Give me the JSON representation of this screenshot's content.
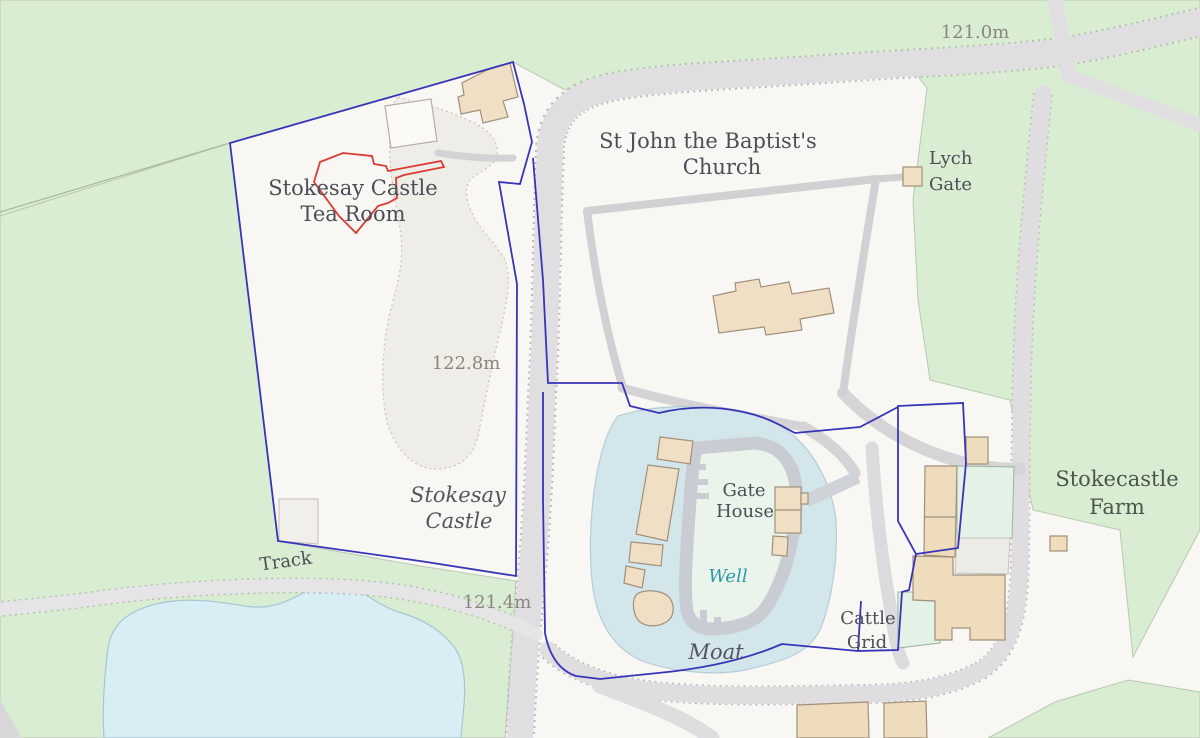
{
  "map": {
    "title": "Stokesay Castle area map",
    "labels": {
      "elevation_top": "121.0m",
      "elevation_mid": "122.8m",
      "elevation_bottom": "121.4m",
      "church": {
        "line1": "St John the Baptist's",
        "line2": "Church"
      },
      "lych_gate": {
        "line1": "Lych",
        "line2": "Gate"
      },
      "tea_room": {
        "line1": "Stokesay Castle",
        "line2": "Tea Room"
      },
      "castle": {
        "line1": "Stokesay",
        "line2": "Castle"
      },
      "gate_house": {
        "line1": "Gate",
        "line2": "House"
      },
      "well": "Well",
      "moat": "Moat",
      "cattle_grid": {
        "line1": "Cattle",
        "line2": "Grid"
      },
      "farm": {
        "line1": "Stokecastle",
        "line2": "Farm"
      },
      "track": "Track"
    },
    "colors": {
      "field_green": "#d9edd2",
      "parcel_white": "#f8f7f4",
      "pond_blue": "#d9edf4",
      "moat_blue": "#d3e6ec",
      "courtyard_mint": "#eaf4ea",
      "building_tan": "#f1dfc5",
      "building_mint": "#e3f2e6",
      "castle_wall_gray": "#c9cdd3",
      "road_gray": "#e0dee1",
      "boundary_blue": "#3834b8",
      "highlight_red": "#da3b33",
      "label_dark": "#4b4e55",
      "label_elevation": "#8b867d",
      "label_water_teal": "#2b99a6"
    }
  }
}
